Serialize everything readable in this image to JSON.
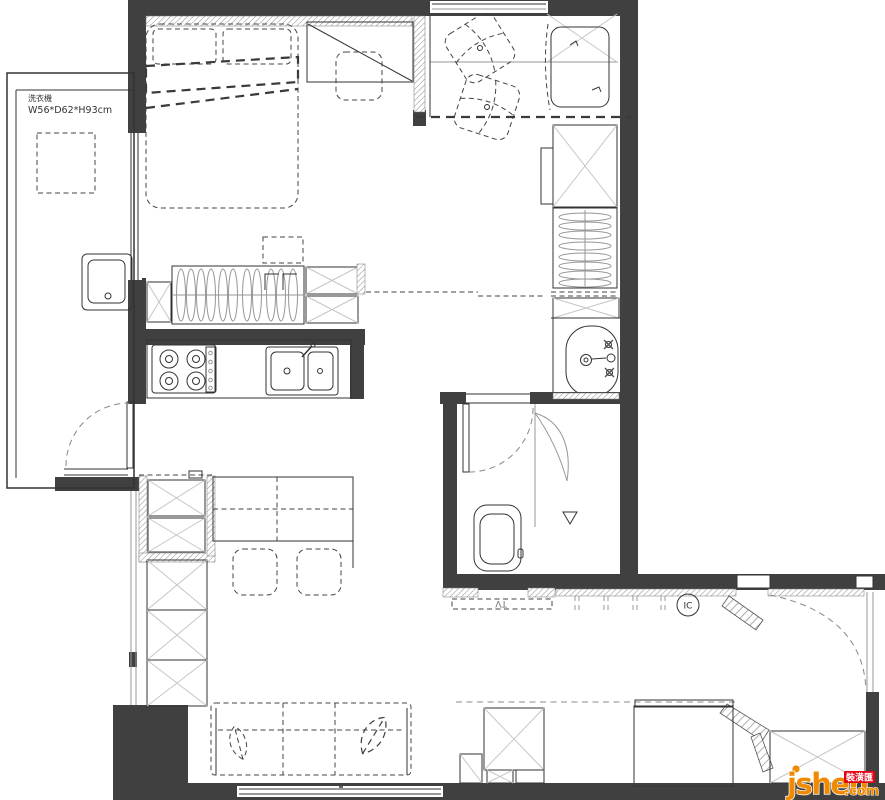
{
  "plan": {
    "washing_machine": {
      "name": "洗衣機",
      "size": "W56*D62*H93cm"
    },
    "tv_label": "TV",
    "intercom_label": "IC"
  },
  "watermark": {
    "brand": "jsheh",
    "suffix": ".com",
    "badge": "裝潢匯"
  },
  "colors": {
    "wall": "#404040",
    "furniture_line": "#333333",
    "light_line": "#c6c6c6",
    "hatch": "#9b9b9b",
    "watermark_orange": "#f08a00",
    "badge_red": "#e60012",
    "background": "#ffffff"
  }
}
